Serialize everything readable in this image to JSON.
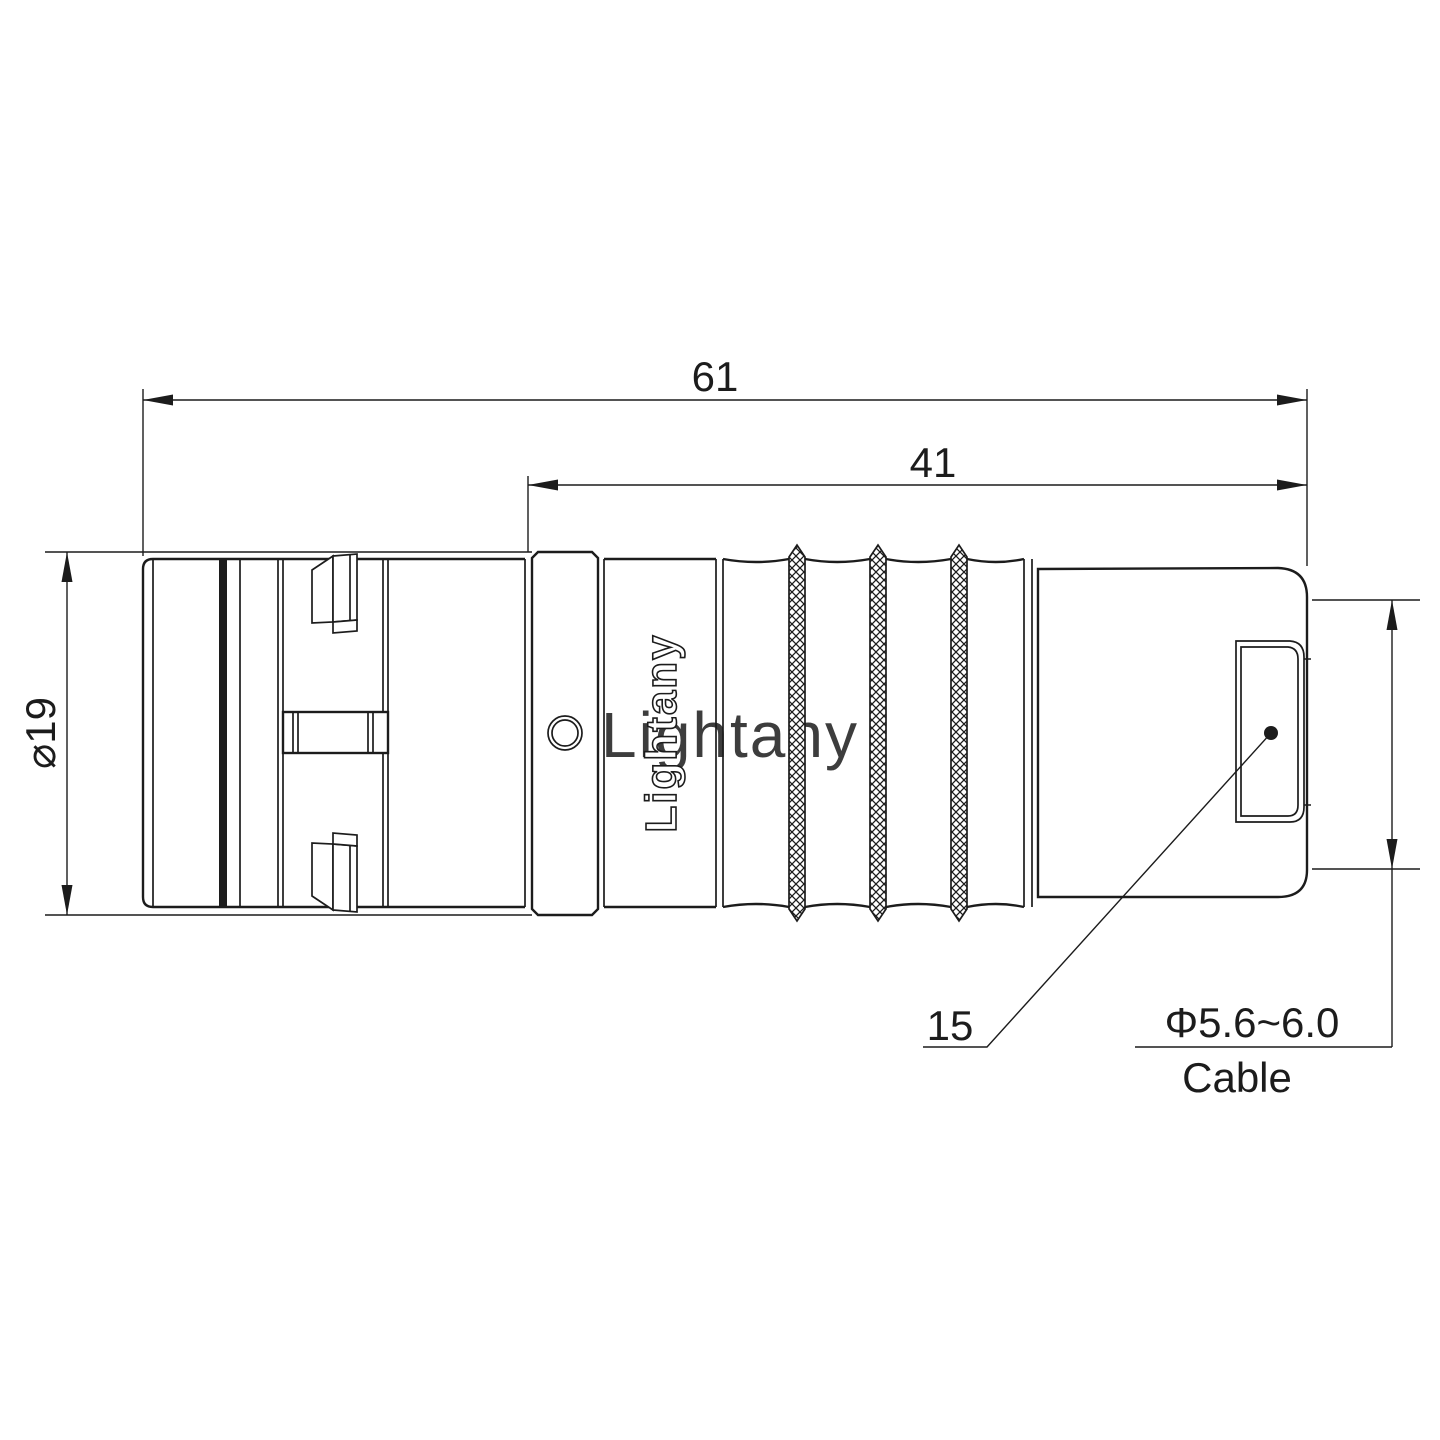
{
  "drawing_labels": {
    "overall_length": "61",
    "rear_length": "41",
    "body_diameter": "⌀19",
    "leader_number": "15",
    "cable_diameter_range": "Φ5.6~6.0",
    "cable_word": "Cable",
    "brand_text": "Lightany",
    "watermark_text": "Lightany"
  },
  "colors": {
    "line": "#1c1c1c",
    "watermark_pink": "#f3b7b0",
    "background": "#ffffff"
  }
}
